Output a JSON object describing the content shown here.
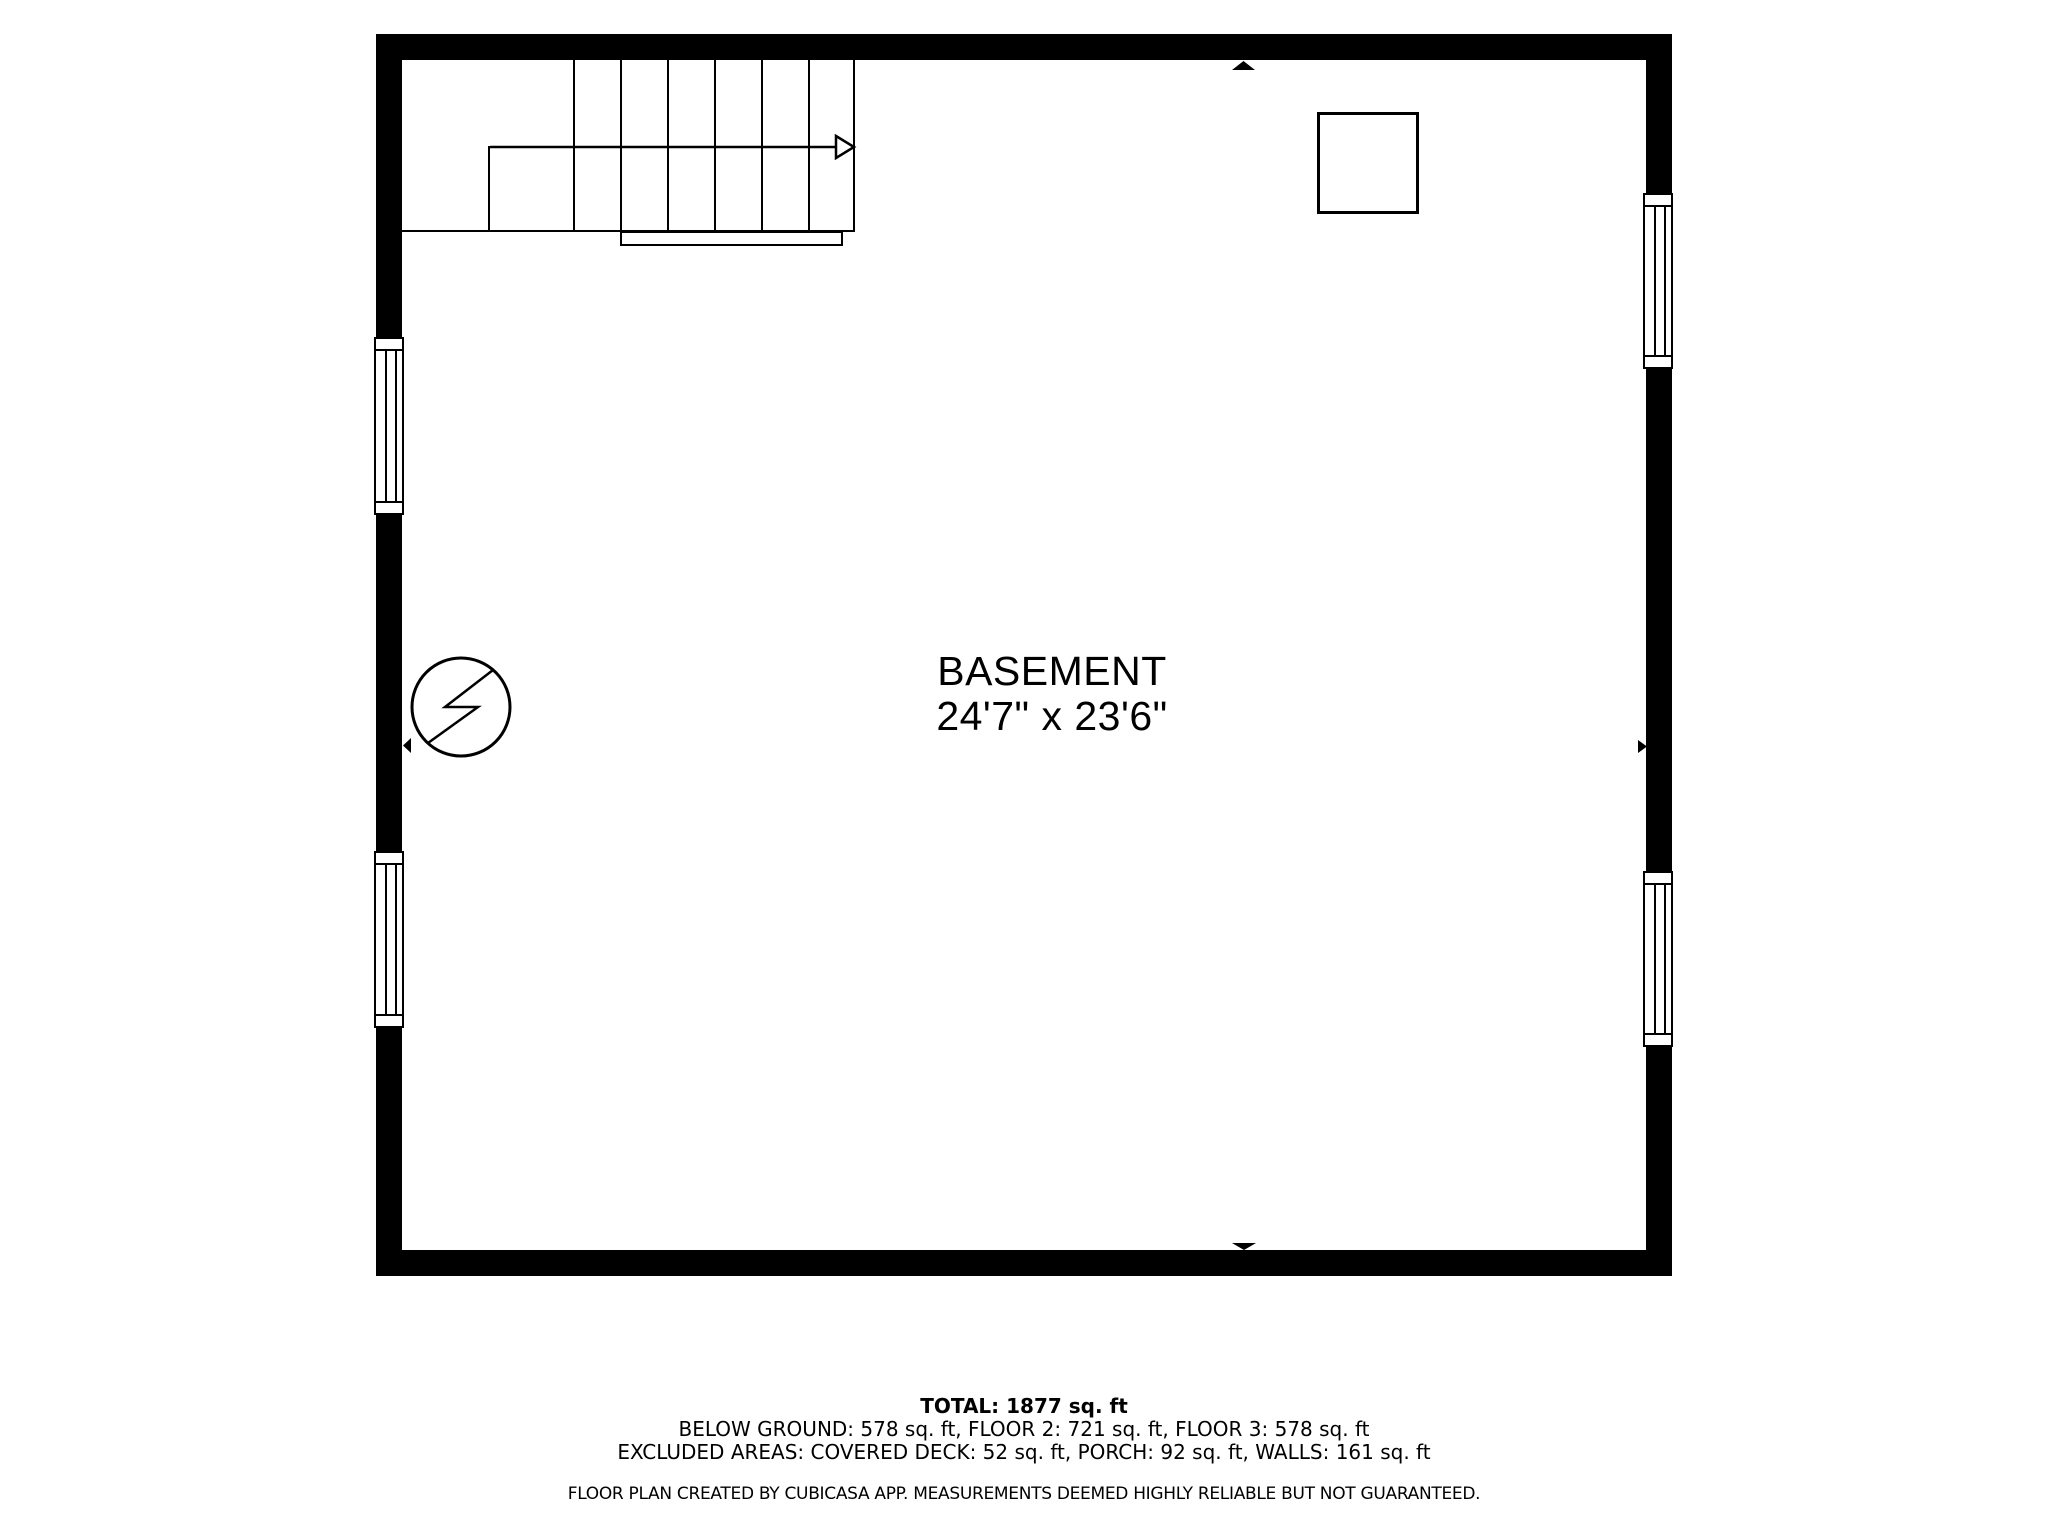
{
  "floor_plan": {
    "room": {
      "name": "BASEMENT",
      "dimensions": "24'7\" x 23'6\""
    },
    "summary": {
      "total_line": "TOTAL: 1877 sq. ft",
      "floors_line": "BELOW GROUND: 578 sq. ft, FLOOR 2: 721 sq. ft, FLOOR 3: 578 sq. ft",
      "excluded_line": "EXCLUDED AREAS: COVERED DECK: 52 sq. ft, PORCH: 92 sq. ft, WALLS: 161 sq. ft",
      "disclaimer": "FLOOR PLAN CREATED BY CUBICASA APP. MEASUREMENTS DEEMED HIGHLY RELIABLE BUT NOT GUARANTEED."
    },
    "symbols": {
      "staircase": "stairs-up-arrow",
      "electrical": "electrical-panel-icon",
      "fixture": "appliance-square",
      "windows": 4,
      "wall_markers": 4
    },
    "colors": {
      "wall": "#000000",
      "line": "#000000",
      "background": "#ffffff",
      "text": "#000000"
    }
  }
}
